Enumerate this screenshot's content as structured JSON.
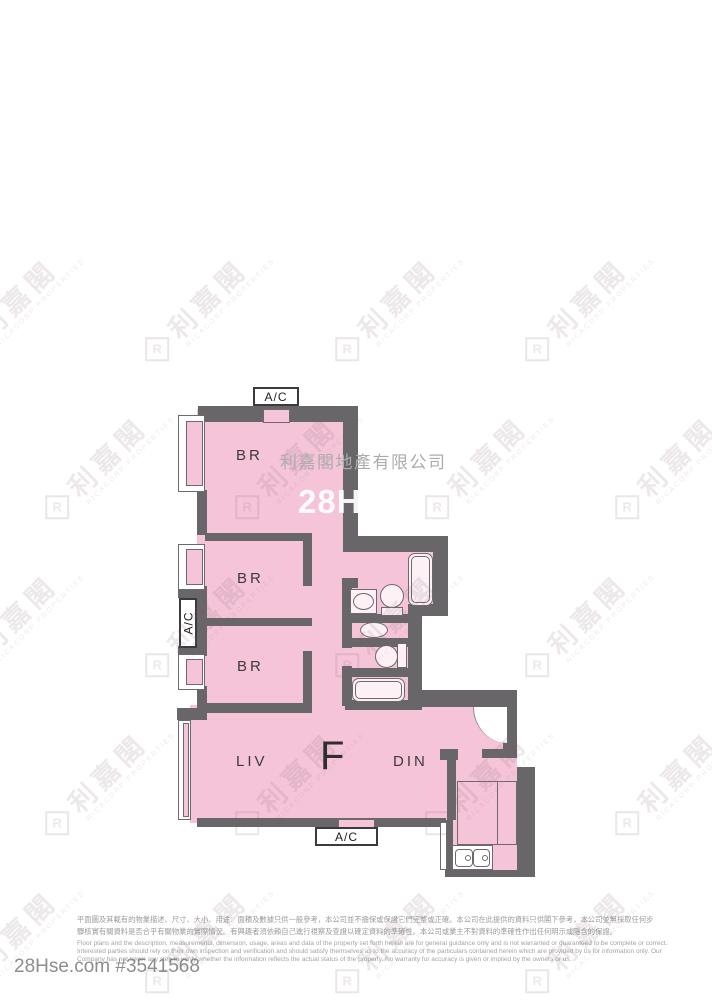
{
  "plan": {
    "unit_label": "F",
    "bedroom1_label": "BR",
    "bedroom2_label": "BR",
    "bedroom3_label": "BR",
    "living_label": "LIV",
    "dining_label": "DIN",
    "ac_top_label": "A/C",
    "ac_left_label": "A/C",
    "ac_bottom_label": "A/C"
  },
  "watermark": {
    "logo_letter": "R",
    "brand_cn": "利嘉閣",
    "brand_sub": "RICACORP PROPERTIES",
    "company_name": "利嘉閣地產有限公司",
    "site_name": "28Hse"
  },
  "footer": {
    "disclaimer_cn_line1": "平面圖及其載有的物業描述、尺寸、大小、用途、面積及數據只供一般參考，本公司並不擔保或保證它們完整或正確。本公司在此提供的資料只供閣下參考，本公司並無採取任何步",
    "disclaimer_cn_line2": "驟核實有關資料是否合乎有關物業的實際情況。有興趣者須依賴自己進行視察及查證以確定資料的準確性。本公司或業主不對資料的準確性作出任何明示或隱含的保證。",
    "disclaimer_en_line1": "Floor plans and the description, measurements, dimension, usage, areas and data of the property set forth herein are for general guidance only and is not warranted or guaranteed to be complete or correct.",
    "disclaimer_en_line2": "Interested parties should rely on their own inspection and verification and should satisfy themselves as to the accuracy of the particulars contained herein which are provided by us for information only.  Our",
    "disclaimer_en_line3": "Company has not taken any step to verify whether the information reflects the actual status of the property.  No warranty for accuracy is given or implied by the owners or us.",
    "listing_id": "28Hse.com #3541568"
  },
  "colors": {
    "room_pink": "#f5c4d8",
    "wall_gray": "#686669",
    "watermark_gray": "#acacac"
  }
}
